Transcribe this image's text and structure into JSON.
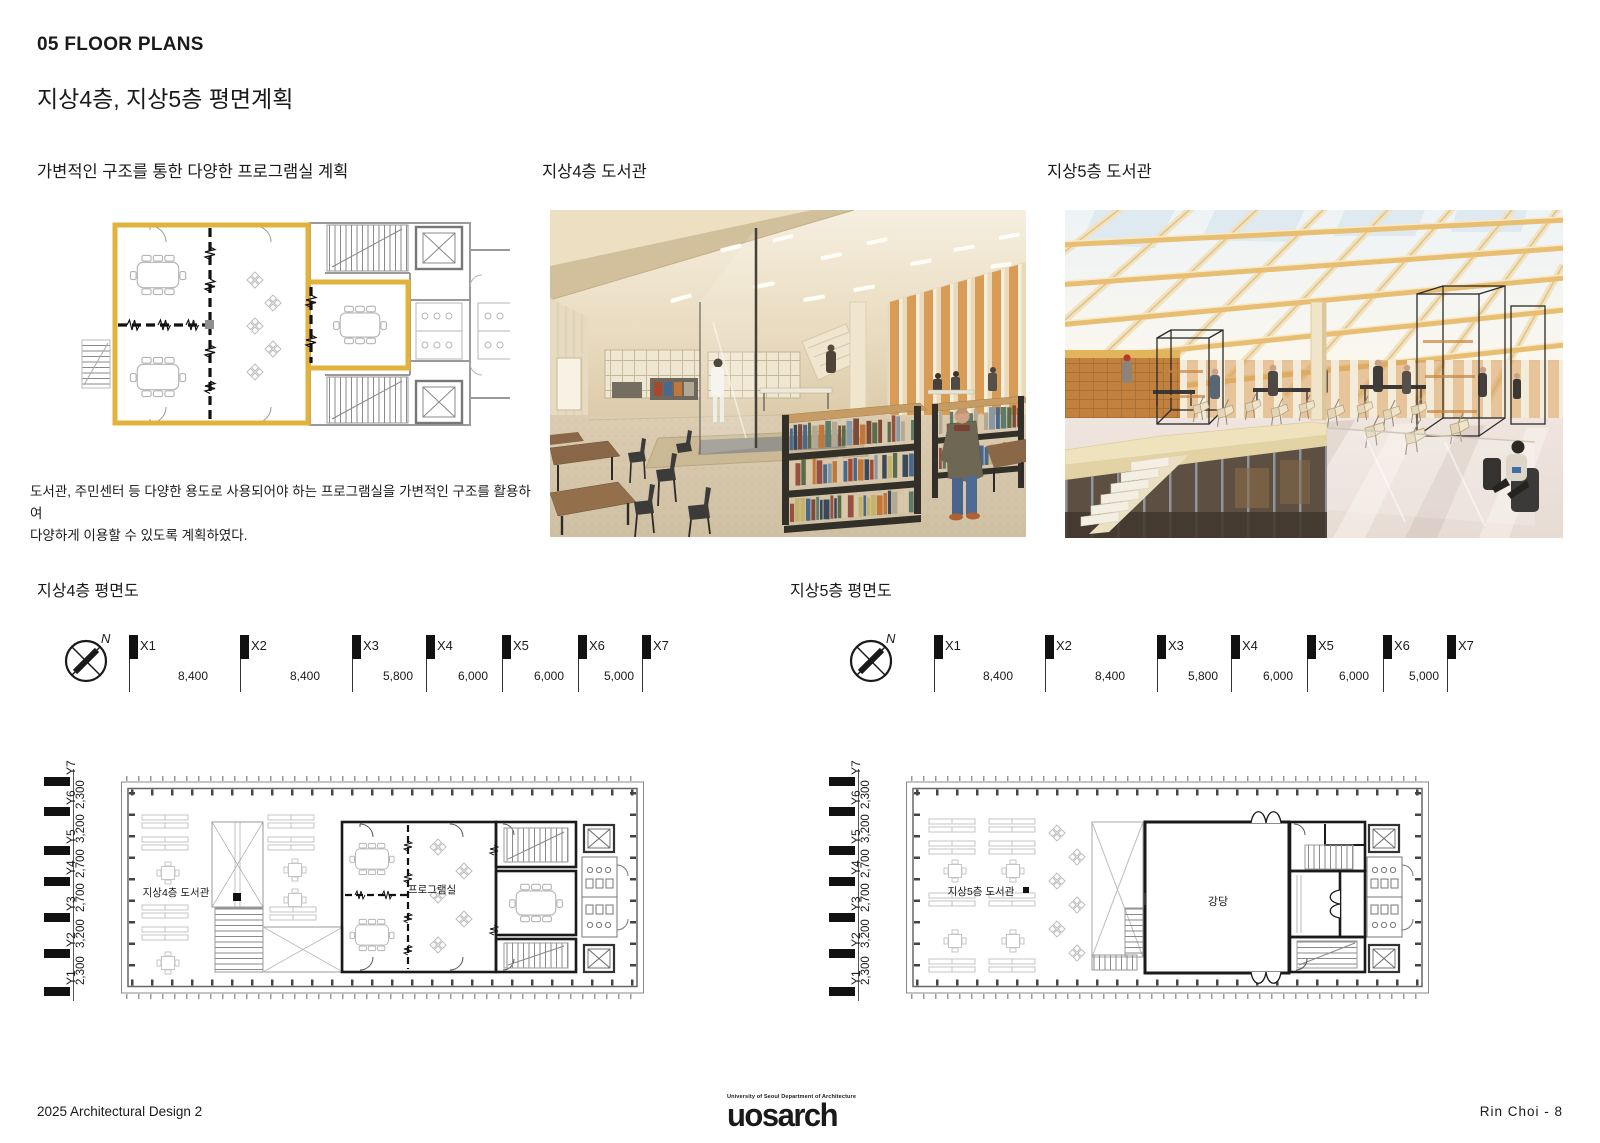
{
  "header": {
    "title": "05 FLOOR PLANS",
    "subtitle": "지상4층, 지상5층 평면계획"
  },
  "concept": {
    "title": "가변적인 구조를 통한 다양한 프로그램실 계획",
    "body": " 도서관, 주민센터 등 다양한 용도로 사용되어야 하는 프로그램실을 가변적인 구조를 활용하여\n다양하게 이용할 수 있도록 계획하였다."
  },
  "renders": {
    "r4": {
      "title": "지상4층 도서관"
    },
    "r5": {
      "title": "지상5층 도서관"
    }
  },
  "plans": {
    "north": "N",
    "x": {
      "labels": [
        "X1",
        "X2",
        "X3",
        "X4",
        "X5",
        "X6",
        "X7"
      ],
      "dims": [
        "8,400",
        "8,400",
        "5,800",
        "6,000",
        "6,000",
        "5,000"
      ]
    },
    "y": {
      "labels": [
        "Y1",
        "Y2",
        "Y3",
        "Y4",
        "Y5",
        "Y6",
        "Y7"
      ],
      "dims": [
        "2,300",
        "3,200",
        "2,700",
        "2,700",
        "3,200",
        "2,300"
      ]
    },
    "f4": {
      "title": "지상4층 평면도",
      "library": "지상4층 도서관",
      "program": "프로그램실"
    },
    "f5": {
      "title": "지상5층 평면도",
      "library": "지상5층 도서관",
      "hall": "강당"
    }
  },
  "footer": {
    "course": "2025 Architectural Design 2",
    "logo_sub": "University of Seoul Department of Architecture",
    "logo": "uosarch",
    "credit": "Rin Choi -  8"
  },
  "colors": {
    "accent_yellow": "#E2B33C",
    "plan_bold": "#1a1a1a",
    "plan_light": "#9a9a9a"
  }
}
